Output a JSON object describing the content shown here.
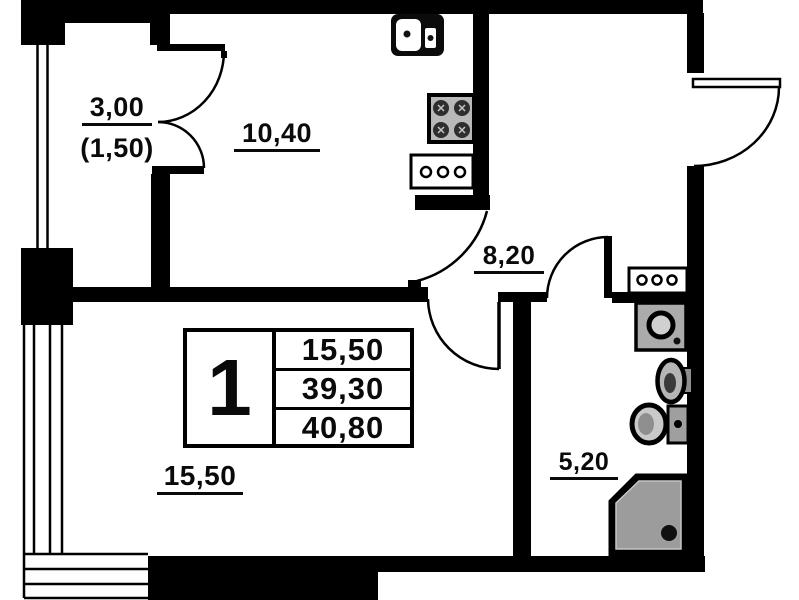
{
  "title": "one-room apartment floor plan",
  "rooms": {
    "balcony": {
      "area": "3,00",
      "area_secondary": "(1,50)"
    },
    "kitchen": {
      "area": "10,40"
    },
    "hallway": {
      "area": "8,20"
    },
    "living_room": {
      "area": "15,50"
    },
    "bathroom": {
      "area": "5,20"
    }
  },
  "stamp": {
    "rooms_count": "1",
    "living_area": "15,50",
    "area_without_balcony": "39,30",
    "total_area": "40,80"
  },
  "fixtures": [
    "kitchen-sink",
    "stove",
    "kitchen-counter",
    "bathroom-counter",
    "washing-machine",
    "washbasin",
    "toilet",
    "shower-tray"
  ],
  "colors": {
    "walls": "#000000",
    "background": "#ffffff",
    "fixture_gray": "#ababab",
    "shower_gray": "#9c9c9c"
  }
}
